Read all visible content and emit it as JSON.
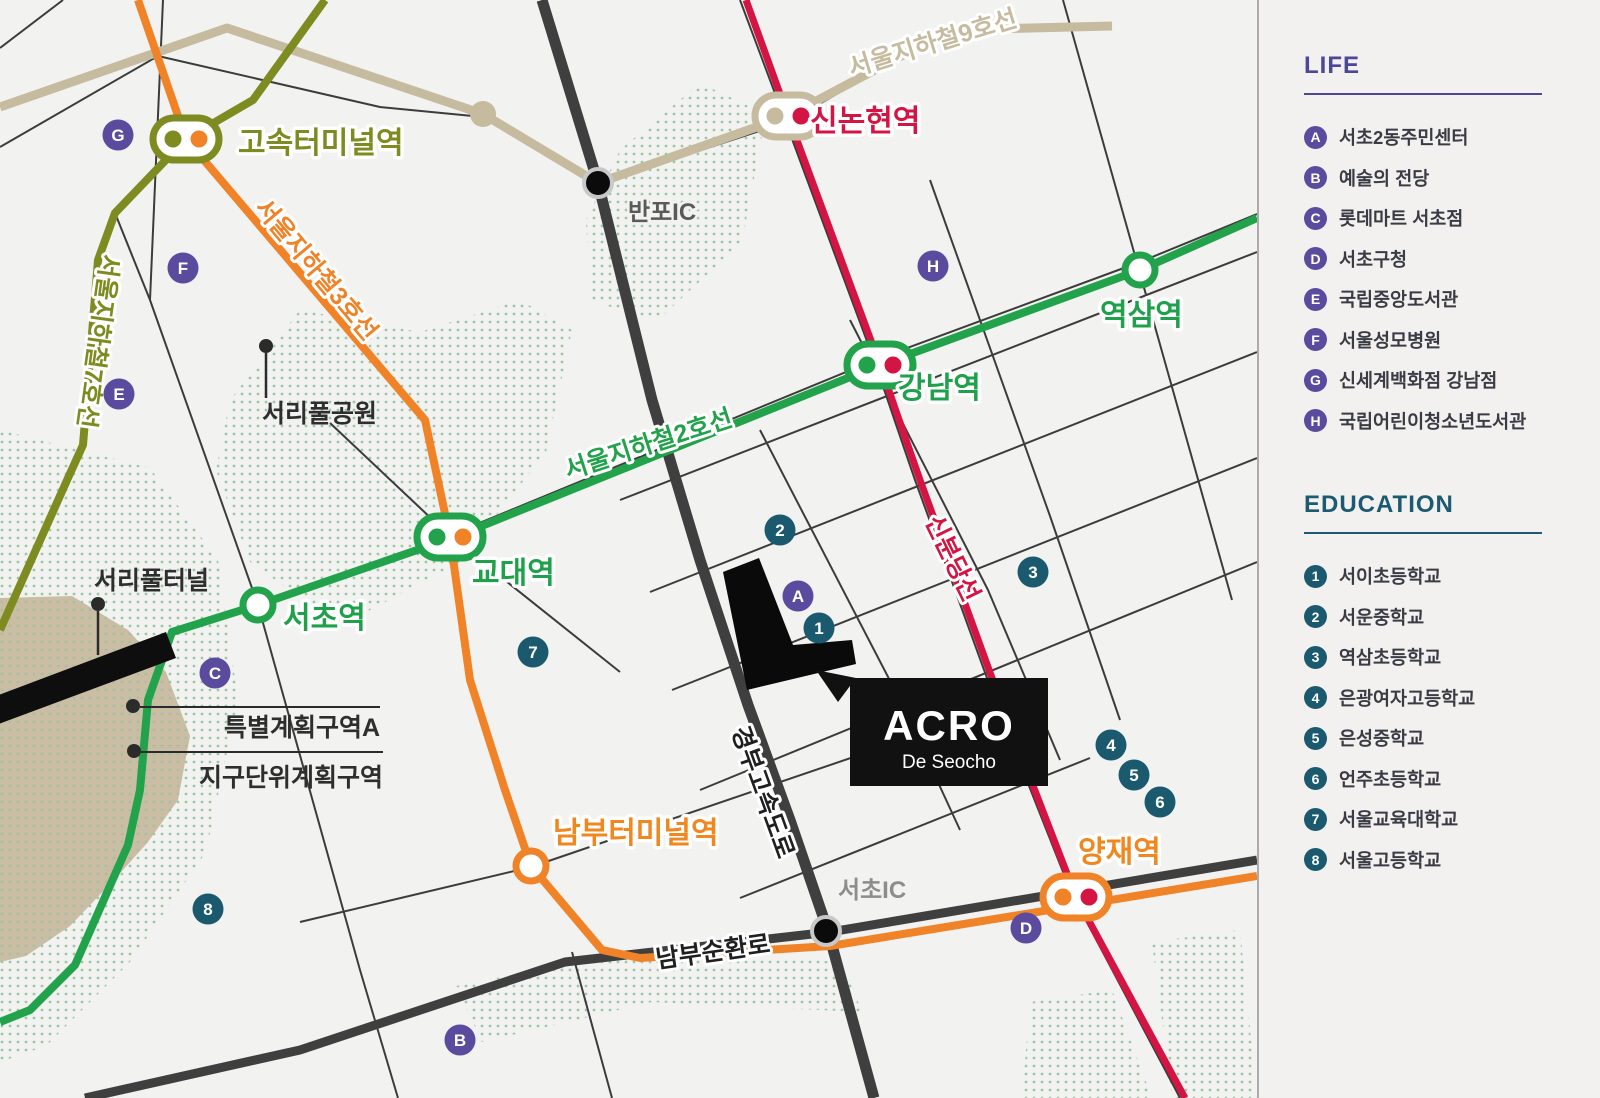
{
  "colors": {
    "line2_green": "#22a24b",
    "line3_orange": "#f08228",
    "line7_olive": "#7e8b20",
    "line9_beige": "#c6bb9f",
    "sinbundang_red": "#d41442",
    "road_dark": "#3f3f3f",
    "badge_purple": "#5a4b9f",
    "badge_teal": "#1b5a6e",
    "life_title": "#4c4796",
    "edu_title": "#1b5a71"
  },
  "map": {
    "lines": {
      "line2": "서울지하철2호선",
      "line3": "서울지하철3호선",
      "line7": "서울지하철7호선",
      "line9": "서울지하철9호선",
      "sinbundang": "신분당선",
      "gyeongbu": "경부고속도로",
      "nambu_ring": "남부순환로"
    },
    "stations": {
      "express_terminal": "고속터미널역",
      "sinnonhyeon": "신논현역",
      "gangnam": "강남역",
      "yeoksam": "역삼역",
      "gyodae": "교대역",
      "seocho": "서초역",
      "nambu_terminal": "남부터미널역",
      "yangjae": "양재역",
      "banpo_ic": "반포IC",
      "seocho_ic": "서초IC"
    },
    "places": {
      "seoripul_park": "서리풀공원",
      "seoripul_tunnel": "서리풀터널",
      "special_district": "특별계획구역A",
      "district_unit_plan": "지구단위계획구역"
    },
    "acro": {
      "title": "ACRO",
      "subtitle": "De Seocho"
    }
  },
  "legend": {
    "life": {
      "title": "LIFE",
      "items": [
        {
          "id": "A",
          "label": "서초2동주민센터"
        },
        {
          "id": "B",
          "label": "예술의 전당"
        },
        {
          "id": "C",
          "label": "롯데마트 서초점"
        },
        {
          "id": "D",
          "label": "서초구청"
        },
        {
          "id": "E",
          "label": "국립중앙도서관"
        },
        {
          "id": "F",
          "label": "서울성모병원"
        },
        {
          "id": "G",
          "label": "신세계백화점 강남점"
        },
        {
          "id": "H",
          "label": "국립어린이청소년도서관"
        }
      ]
    },
    "education": {
      "title": "EDUCATION",
      "items": [
        {
          "id": "1",
          "label": "서이초등학교"
        },
        {
          "id": "2",
          "label": "서운중학교"
        },
        {
          "id": "3",
          "label": "역삼초등학교"
        },
        {
          "id": "4",
          "label": "은광여자고등학교"
        },
        {
          "id": "5",
          "label": "은성중학교"
        },
        {
          "id": "6",
          "label": "언주초등학교"
        },
        {
          "id": "7",
          "label": "서울교육대학교"
        },
        {
          "id": "8",
          "label": "서울고등학교"
        }
      ]
    }
  }
}
